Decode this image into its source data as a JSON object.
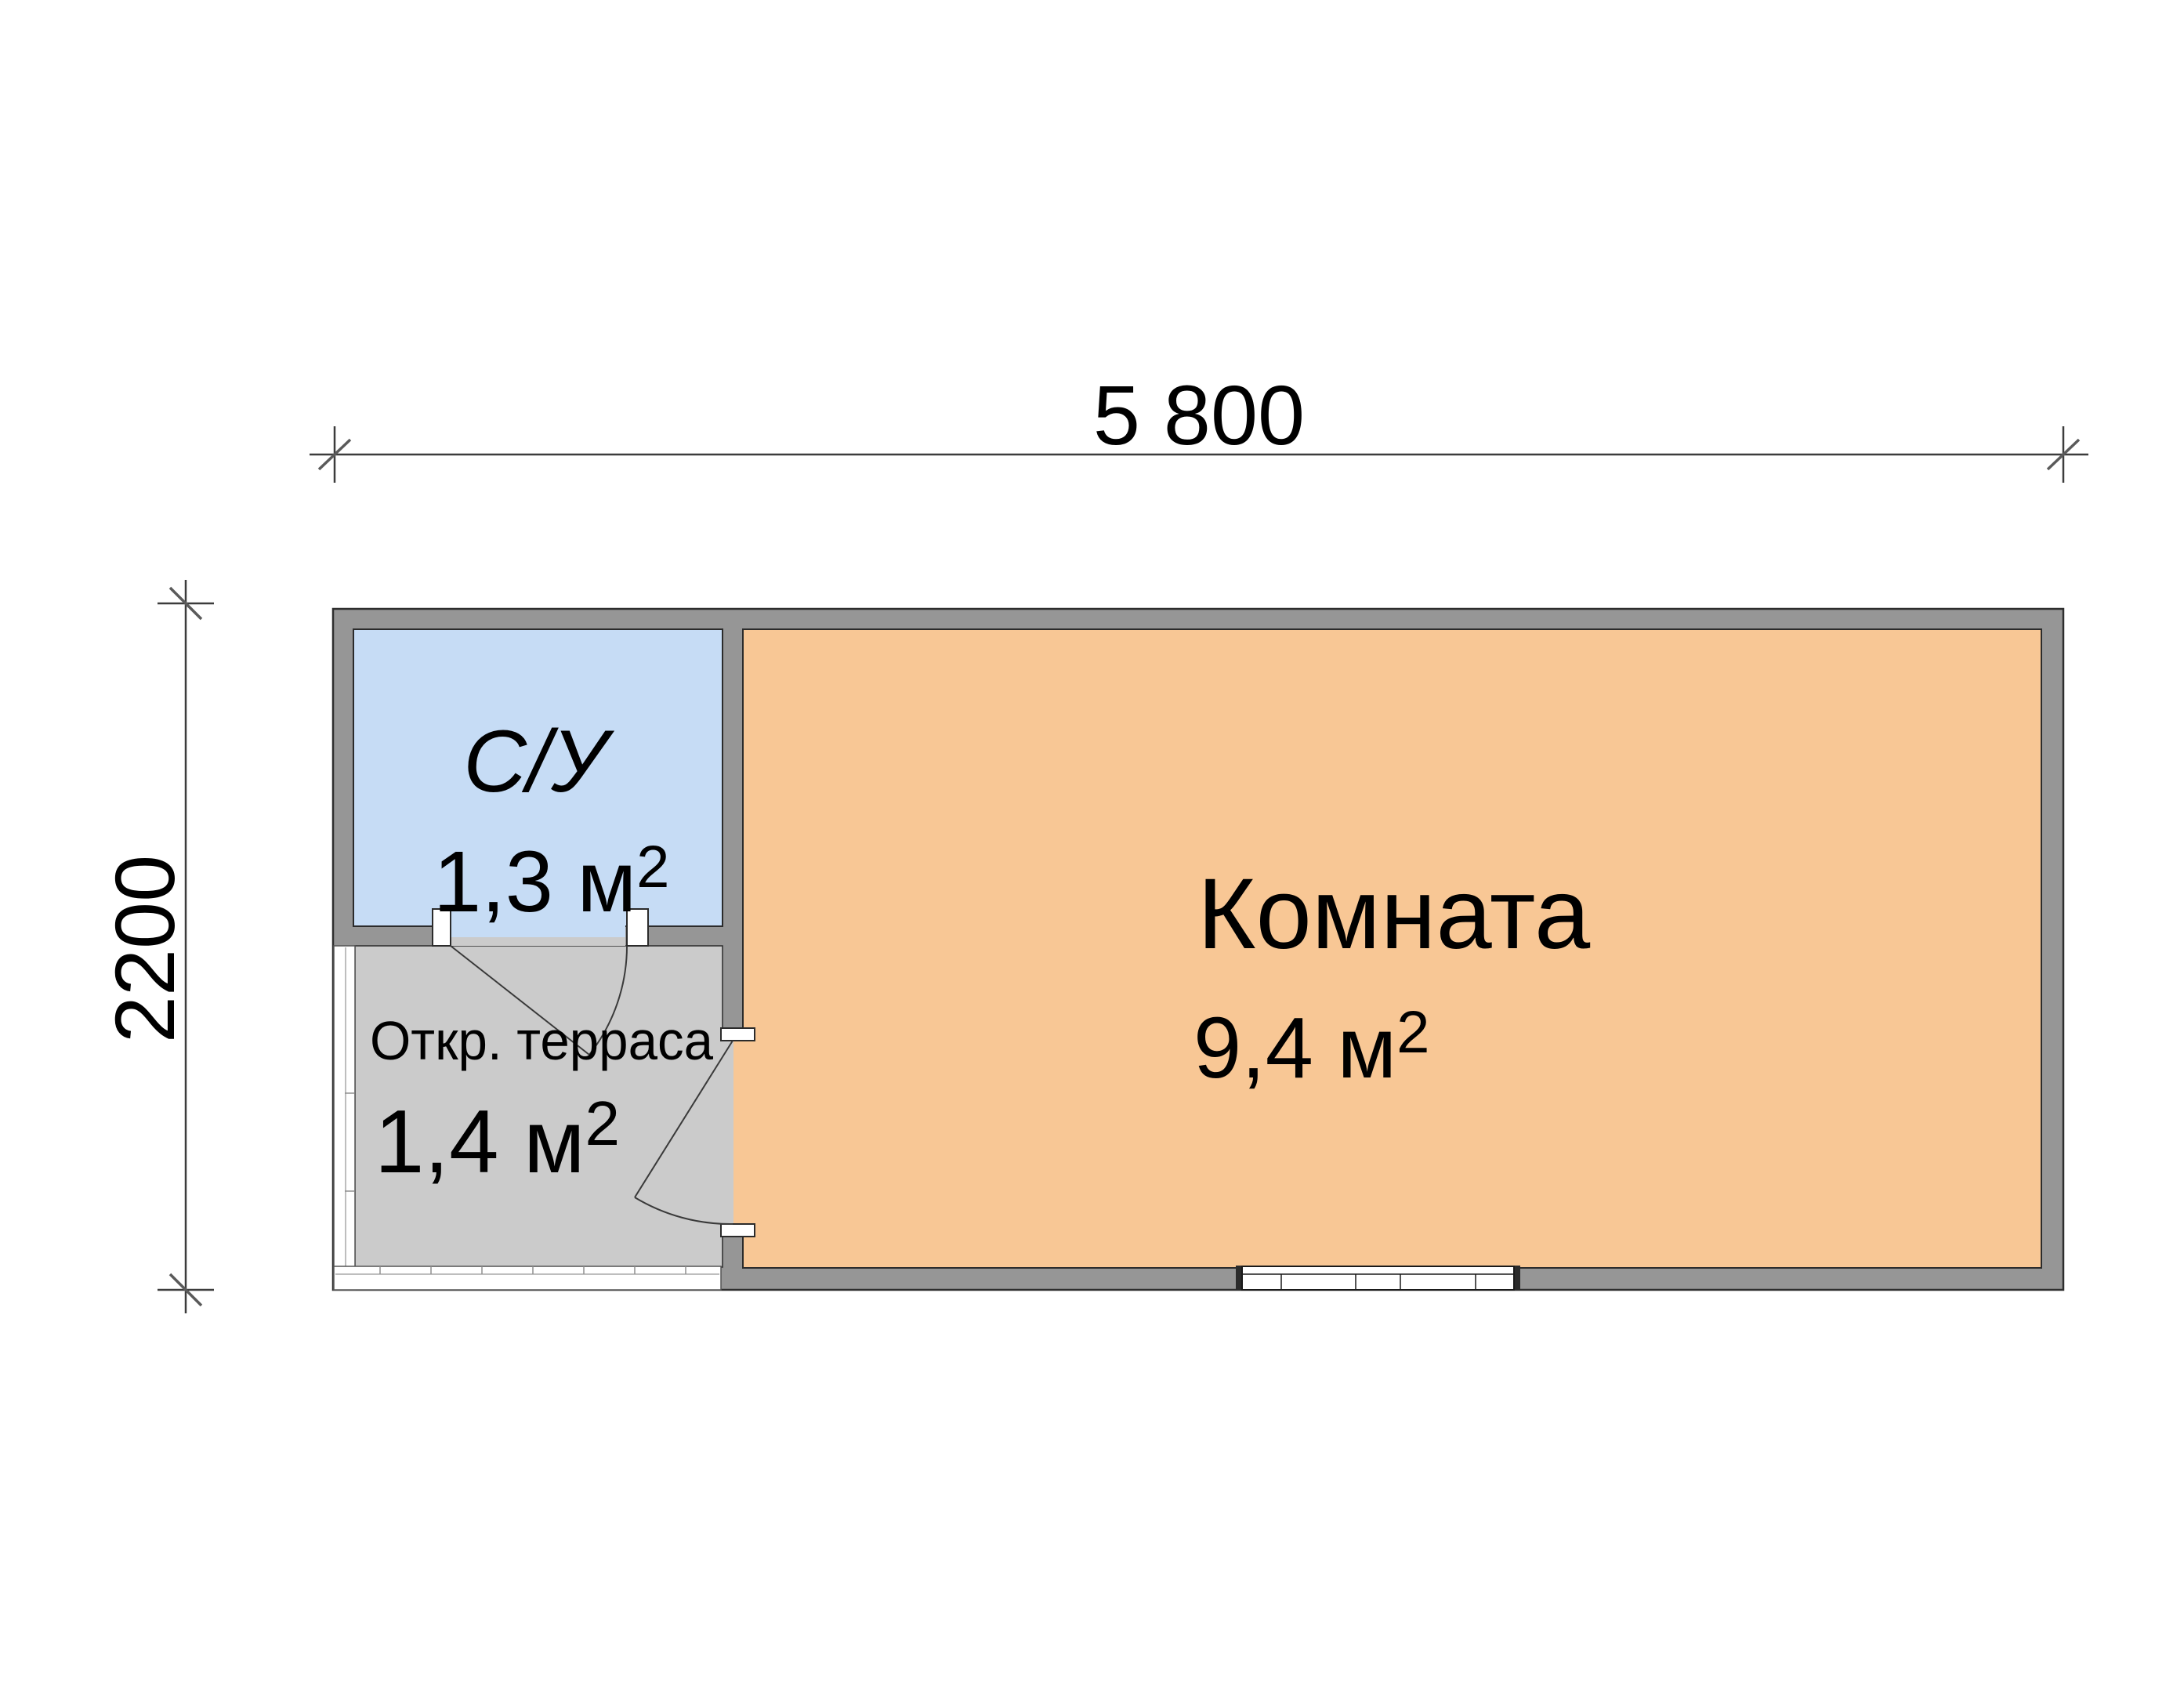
{
  "plan": {
    "dim_width_label": "5 800",
    "dim_height_label": "2200"
  },
  "rooms": [
    {
      "label": "С/У",
      "area_main": "1,3 м",
      "area_sup": "2",
      "fill": "#c6dcf5"
    },
    {
      "label": "Откр. терраса",
      "area_main": "1,4 м",
      "area_sup": "2",
      "fill": "#cbcbcb"
    },
    {
      "label": "Комната",
      "area_main": "9,4 м",
      "area_sup": "2",
      "fill": "#f8c795"
    }
  ],
  "colors": {
    "wall_fill": "#969696",
    "wall_outline": "#2e2e2e",
    "dim_line": "#3c3c3c",
    "text": "#000000",
    "open_edge": "#ffffff",
    "window_frame": "#1a1a1a"
  }
}
